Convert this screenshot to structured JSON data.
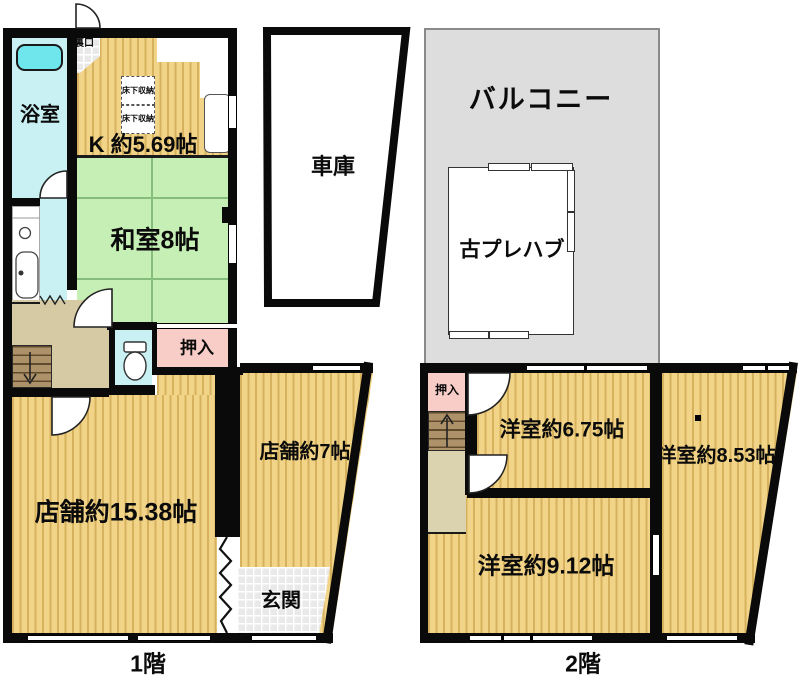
{
  "document_type": "floor-plan",
  "floor1": {
    "caption": "1階",
    "labels": {
      "bathroom": "浴室",
      "back_door": "裏口",
      "kitchen": "K 約5.69帖",
      "underfloor_storage_1": "床下収納",
      "underfloor_storage_2": "床下収納",
      "japanese_room": "和室8帖",
      "closet": "押入",
      "shop_large": "店舗約15.38帖",
      "shop_small": "店舗約7帖",
      "entrance": "玄関",
      "garage": "車庫"
    }
  },
  "floor2": {
    "caption": "2階",
    "labels": {
      "balcony": "バルコニー",
      "prefab": "古プレハブ",
      "closet": "押入",
      "western_room_675": "洋室約6.75帖",
      "western_room_853": "洋室約8.53帖",
      "western_room_912": "洋室約9.12帖"
    }
  },
  "colors": {
    "wood_floor": "#F2D488",
    "tatami_green": "#C6EFB6",
    "closet_pink": "#F8CDC8",
    "bath_cyan": "#C9F1F4",
    "bathtub_cyan": "#6FE6EC",
    "hallway_tan": "#D6CAA4",
    "corridor_beige": "#DBD3AF",
    "stairs_brown": "#AD9168",
    "balcony_gray": "#DDDDDD",
    "wall_black": "#0A0A0A"
  }
}
